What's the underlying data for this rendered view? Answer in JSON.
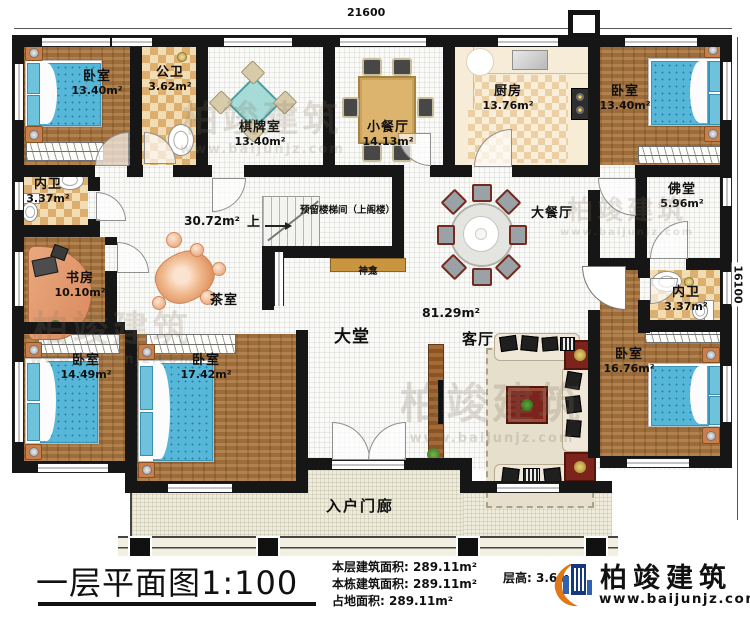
{
  "dimensions": {
    "top": "21600",
    "right": "16100"
  },
  "watermark": {
    "brand": "柏竣建筑",
    "url": "www.baijunjz.com"
  },
  "colors": {
    "wall": "#161616",
    "wood_floor": "#a8743e",
    "tile": "#dcaf6e",
    "bed": "#57b7d8",
    "porch": "#efecdc",
    "shrine": "#c9953f",
    "brand_blue": "#16387c",
    "brand_orange": "#e07818"
  },
  "rooms": {
    "bedroom_tl": {
      "name": "卧室",
      "area": "13.40m²"
    },
    "public_bath": {
      "name": "公卫",
      "area": "3.62m²"
    },
    "chess_room": {
      "name": "棋牌室",
      "area": "13.40m²"
    },
    "small_dining": {
      "name": "小餐厅",
      "area": "14.13m²"
    },
    "kitchen": {
      "name": "厨房",
      "area": "13.76m²"
    },
    "bedroom_tr": {
      "name": "卧室",
      "area": "13.40m²"
    },
    "inner_bath_left": {
      "name": "内卫",
      "area": "3.37m²"
    },
    "study": {
      "name": "书房",
      "area": "10.10m²"
    },
    "buddha_hall": {
      "name": "佛堂",
      "area": "5.96m²"
    },
    "inner_bath_right": {
      "name": "内卫",
      "area": "3.37m²"
    },
    "bedroom_br": {
      "name": "卧室",
      "area": "16.76m²"
    },
    "bedroom_bl": {
      "name": "卧室",
      "area": "14.49m²"
    },
    "bedroom_bm": {
      "name": "卧室",
      "area": "17.42m²"
    }
  },
  "open_areas": {
    "hall": "大堂",
    "hall_area": "81.29m²",
    "living": "客厅",
    "large_dining": "大餐厅",
    "corridor_area": "30.72m²",
    "tea_room": "茶室",
    "porch": "入户门廊",
    "shrine": "神龛",
    "stairs_note": "预留楼梯间（上阁楼）",
    "stairs_up": "上"
  },
  "footer": {
    "title": "一层平面图1:100",
    "stats": [
      {
        "label": "本层建筑面积:",
        "value": "289.11m²"
      },
      {
        "label": "本栋建筑面积:",
        "value": "289.11m²"
      },
      {
        "label": "占地面积:",
        "value": "289.11m²"
      }
    ],
    "floor_height": {
      "label": "层高:",
      "value": "3.6m"
    },
    "brand": "柏竣建筑",
    "brand_url": "www.baijunjz.com"
  }
}
